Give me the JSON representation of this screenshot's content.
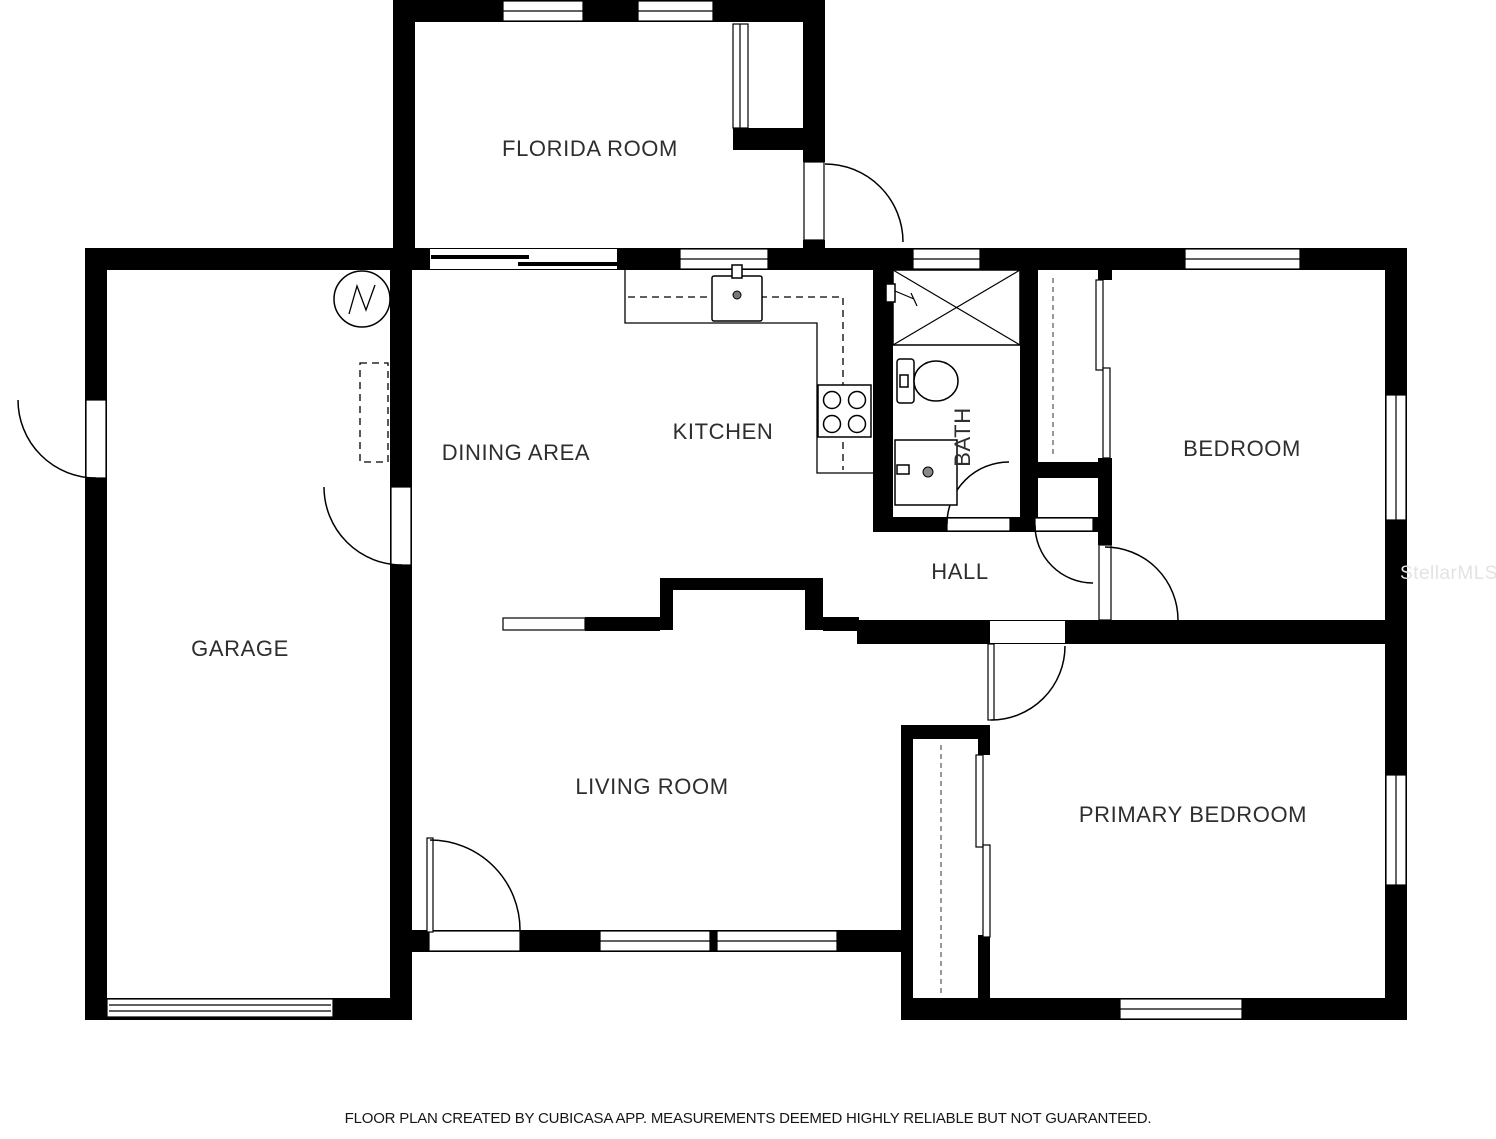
{
  "page": {
    "background": "#ffffff",
    "wall_color": "#000000",
    "label_color": "#2e2e2e"
  },
  "floor_plan": {
    "type": "residential-2d-floor-plan",
    "rooms": {
      "florida_room": "FLORIDA ROOM",
      "dining_area": "DINING AREA",
      "kitchen": "KITCHEN",
      "bath": "BATH",
      "bedroom": "BEDROOM",
      "garage": "GARAGE",
      "hall": "HALL",
      "living_room": "LIVING ROOM",
      "primary_bedroom": "PRIMARY BEDROOM"
    },
    "fixtures": [
      "water-heater-symbol",
      "kitchen-counter",
      "kitchen-sink",
      "stove-four-burners",
      "upper-cabinets-dashed",
      "shower-with-x",
      "shower-valve",
      "toilet",
      "vanity-sink",
      "bedroom-closet-sliding-doors",
      "primary-closet-sliding-doors",
      "closet-rods",
      "fireplace-niche",
      "half-wall",
      "garage-overhead-door",
      "door-swing-arcs",
      "windows"
    ]
  },
  "watermark": {
    "text": "StellarMLS",
    "color": "#e3e3e3"
  },
  "footer": {
    "disclaimer": "FLOOR PLAN CREATED BY CUBICASA APP. MEASUREMENTS DEEMED HIGHLY RELIABLE BUT NOT GUARANTEED."
  }
}
